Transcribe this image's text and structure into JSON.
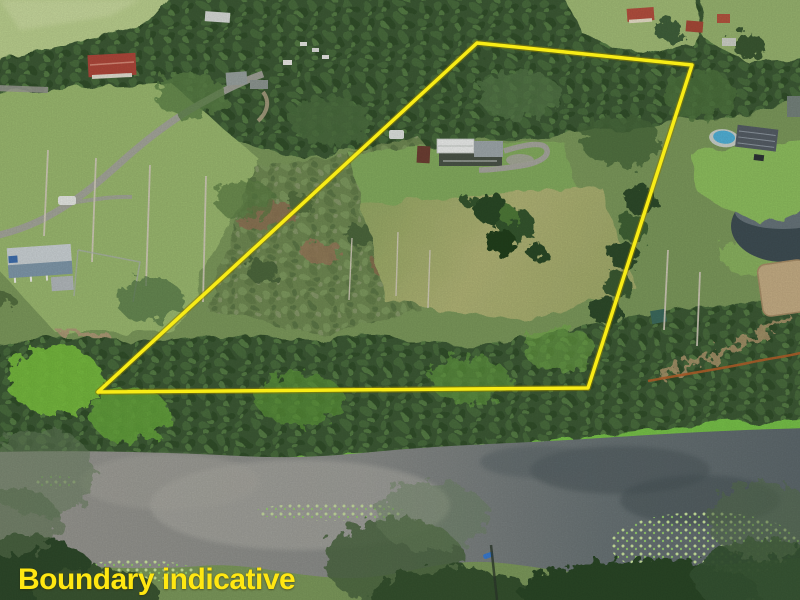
{
  "annotation": {
    "caption": "Boundary indicative",
    "color": "#ffe712",
    "position": "bottom-left"
  },
  "boundary": {
    "points": "477,43 692,65 588,388 98,392",
    "color": "#f8ec16",
    "stroke_width": 3.5,
    "style": "solid-yellow-polygon"
  },
  "colors": {
    "boundary_yellow": "#f8ec16",
    "caption_yellow": "#ffe712",
    "river_water_left": "#97968e",
    "river_water_right": "#5e696d",
    "riverbank_green": "#7cc94b",
    "paddock_grass": "#a9b276",
    "house_lawn": "#85ad5f",
    "forest_dark": "#3c5a34",
    "scrub_green": "#6f8a52",
    "dirt_brown": "#96795a",
    "road_grey": "#a5a59d",
    "pool_blue": "#52b2d8",
    "pond_dark": "#3f4e54",
    "sand_arena": "#c6ae85",
    "red_roof": "#b0483b",
    "white_roof": "#edefed",
    "orange_track": "#b4602a"
  },
  "scene": {
    "image_type": "aerial-drone-photo",
    "landmarks": [
      "main-house",
      "main-house-driveway",
      "house-lawn",
      "cleared-paddock",
      "paddock-tree-clump",
      "scrub-bushland",
      "left-grass-slope",
      "rural-road",
      "river",
      "riverbank",
      "water-lily-patches",
      "canoe",
      "neighbour-pond",
      "sand-arena",
      "orange-dirt-track",
      "neighbour-house-with-pool",
      "neighbour-house-left",
      "red-roof-house-top-left",
      "top-right-houses",
      "caravan",
      "sheds",
      "tree-canopy",
      "top-left-field"
    ]
  }
}
